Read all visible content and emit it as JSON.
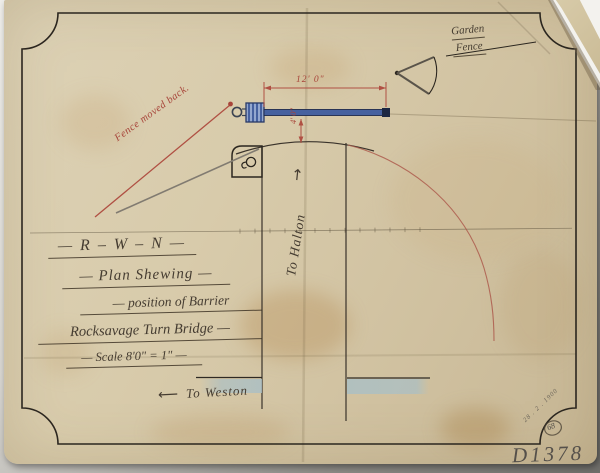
{
  "scan": {
    "title_block": {
      "line1": "— R – W – N —",
      "line2": "— Plan Shewing —",
      "line3": "— position of Barrier",
      "line4": "Rocksavage Turn Bridge —",
      "line5": "— Scale 8'0\" = 1\" —"
    },
    "labels": {
      "garden_fence_line1": "Garden",
      "garden_fence_line2": "Fence",
      "fence_moved_back": "Fence moved back.",
      "to_halton": "To Halton",
      "to_halton_arrow": "↑",
      "to_weston": "To Weston",
      "to_weston_arrow": "⟵"
    },
    "dimensions": {
      "barrier_length": "12' 0\"",
      "barrier_offset": "4' 0\""
    },
    "annotations": {
      "reference_number": "D1378",
      "stamp_number": "68",
      "corner_note": "28 . 2 . 1900"
    },
    "colors": {
      "red_ink": "#a8453a",
      "blue_ink": "#3e5d9e",
      "black_ink": "#2b261f",
      "paper": "#d8cbab",
      "water": "#a9bfc6"
    }
  }
}
